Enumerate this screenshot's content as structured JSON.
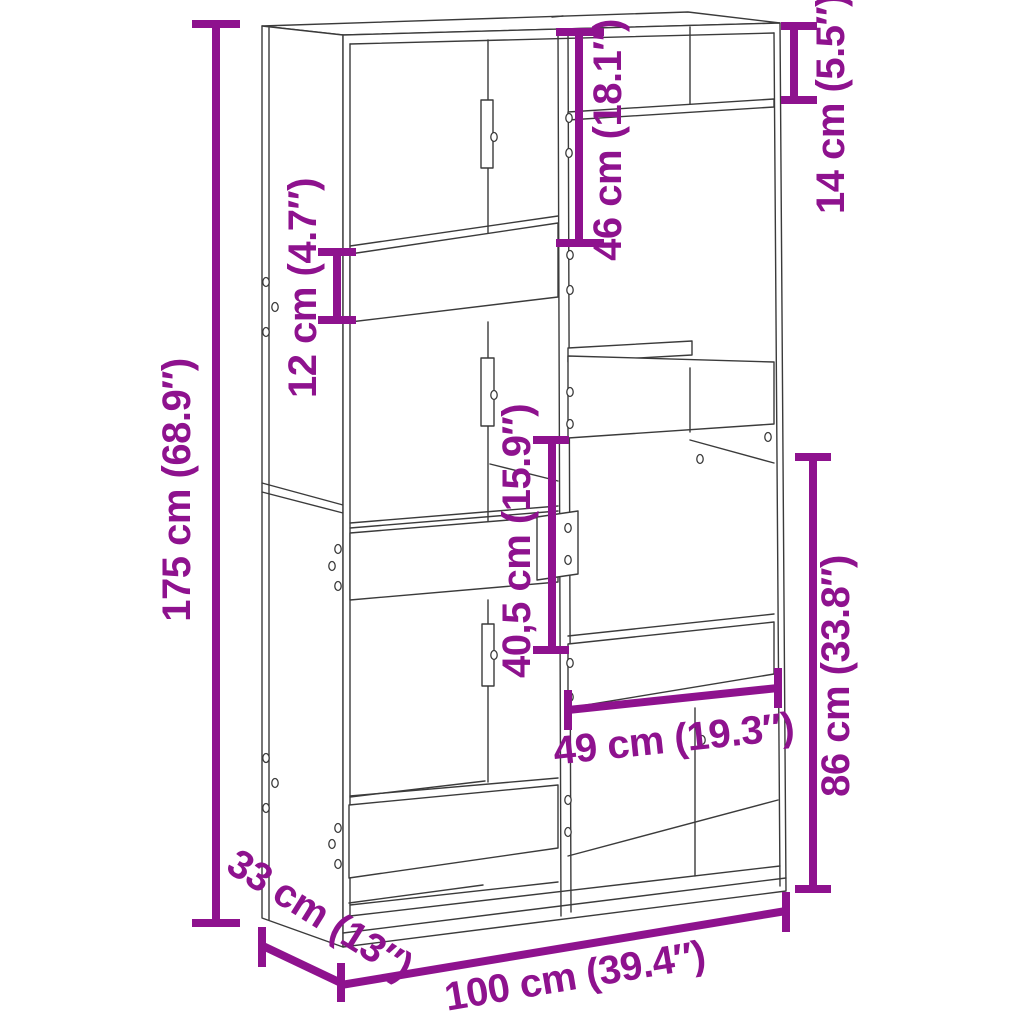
{
  "diagram": {
    "type": "product-dimension-diagram",
    "product": "bookcase-room-divider-line-drawing",
    "background_color": "#ffffff",
    "colors": {
      "dimension": "#8e128e",
      "line_art": "#3b3b3b"
    },
    "dimensions": {
      "height": {
        "label": "175 cm (68.9″)",
        "cm": "175",
        "inches": "68.9"
      },
      "shelf_band": {
        "label": "12 cm (4.7″)",
        "cm": "12",
        "inches": "4.7"
      },
      "top_compartment": {
        "label": "46 cm (18.1″)",
        "cm": "46",
        "inches": "18.1"
      },
      "top_right_shelf": {
        "label": "14 cm (5.5″)",
        "cm": "14",
        "inches": "5.5"
      },
      "middle_compartment": {
        "label": "40,5 cm (15.9″)",
        "cm": "40,5",
        "inches": "15.9"
      },
      "lower_right": {
        "label": "86 cm (33.8″)",
        "cm": "86",
        "inches": "33.8"
      },
      "compartment_width": {
        "label": "49 cm (19.3″)",
        "cm": "49",
        "inches": "19.3"
      },
      "depth": {
        "label": "33 cm (13″)",
        "cm": "33",
        "inches": "13"
      },
      "width": {
        "label": "100 cm (39.4″)",
        "cm": "100",
        "inches": "39.4"
      }
    }
  }
}
